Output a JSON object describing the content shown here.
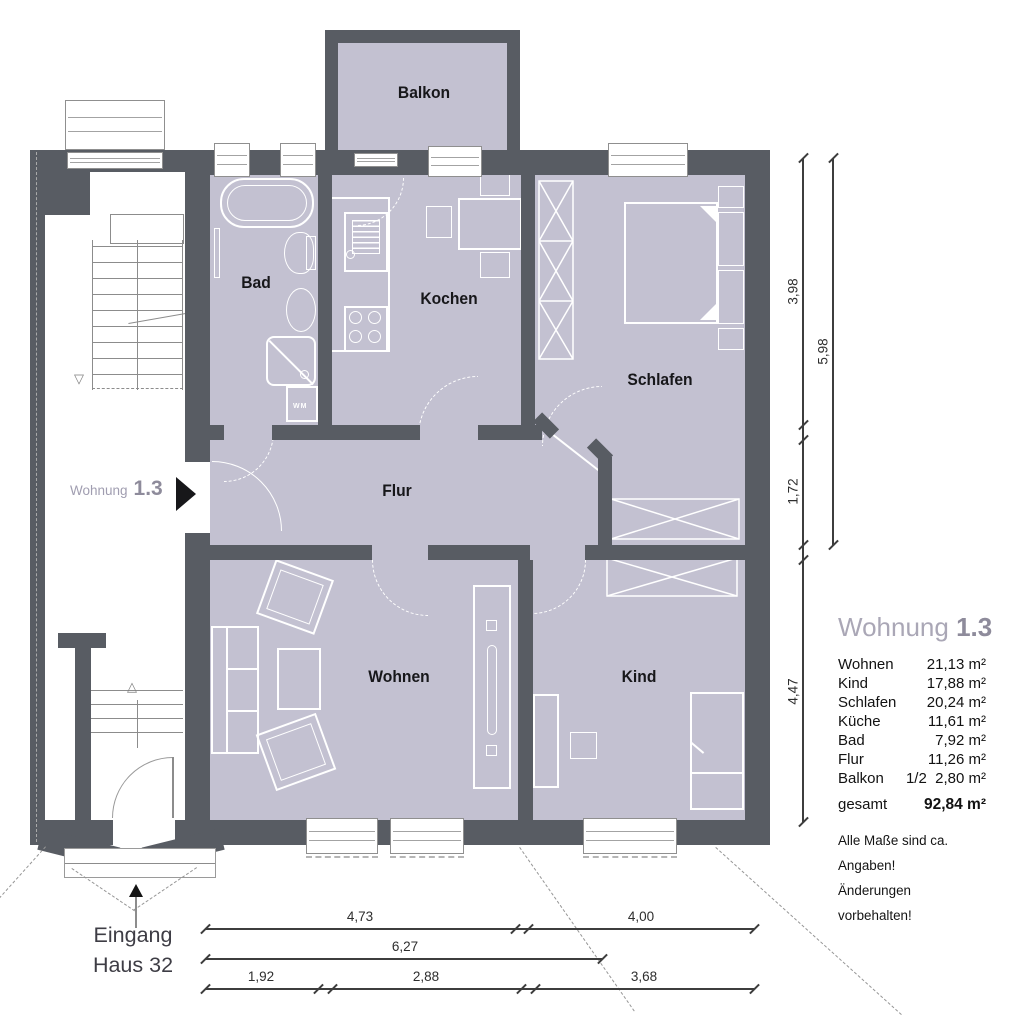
{
  "rooms": {
    "balkon": "Balkon",
    "bad": "Bad",
    "kochen": "Kochen",
    "schlafen": "Schlafen",
    "flur": "Flur",
    "wohnen": "Wohnen",
    "kind": "Kind",
    "wm": "WM"
  },
  "entrance_tag": {
    "light": "Wohnung",
    "bold": "1.3"
  },
  "building_entrance": {
    "line1": "Eingang",
    "line2": "Haus 32"
  },
  "dims": {
    "v1": "3,98",
    "v2": "5,98",
    "v3": "1,72",
    "v4": "4,47",
    "b1": "4,73",
    "b2": "4,00",
    "b3": "6,27",
    "b4": "1,92",
    "b5": "2,88",
    "b6": "3,68"
  },
  "legend": {
    "title_light": "Wohnung",
    "title_bold": "1.3",
    "rows": [
      {
        "label": "Wohnen",
        "value": "21,13 m²"
      },
      {
        "label": "Kind",
        "value": "17,88 m²"
      },
      {
        "label": "Schlafen",
        "value": "20,24 m²"
      },
      {
        "label": "Küche",
        "value": "11,61 m²"
      },
      {
        "label": "Bad",
        "value": "7,92 m²"
      },
      {
        "label": "Flur",
        "value": "11,26 m²"
      },
      {
        "label": "Balkon",
        "value": "1/2  2,80 m²"
      }
    ],
    "total_label": "gesamt",
    "total_value": "92,84 m²",
    "notes": [
      "Alle Maße sind ca. Angaben!",
      "Änderungen vorbehalten!"
    ]
  },
  "icons": {
    "stairs_up": "△",
    "stairs_down": "▽"
  },
  "colors": {
    "wall": "#585c63",
    "floor": "#c3c1d1",
    "accent": "#8e8b9b",
    "accent_light": "#aaa7b6"
  }
}
